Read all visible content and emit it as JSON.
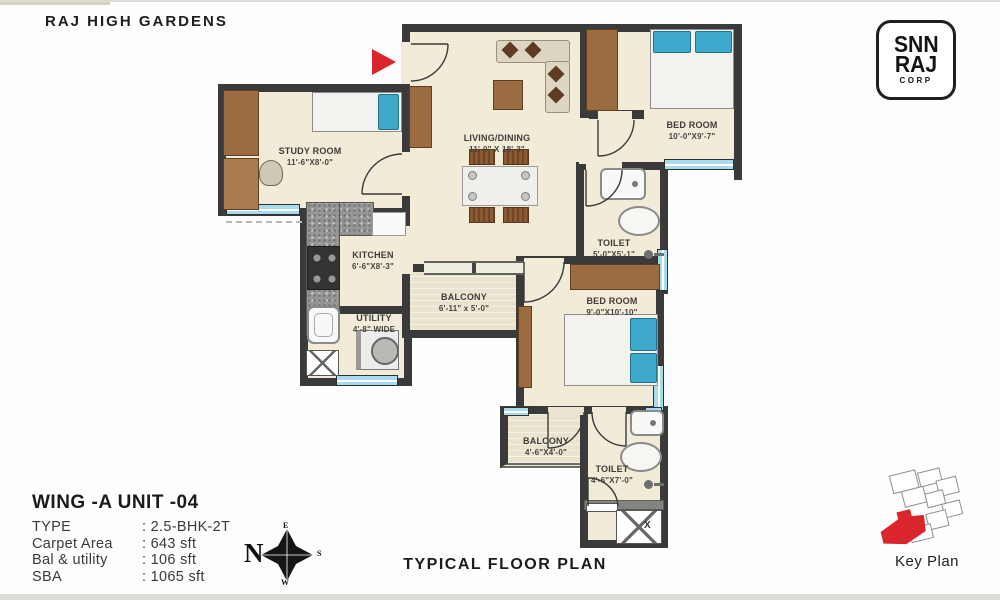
{
  "header": {
    "project_title": "RAJ HIGH GARDENS"
  },
  "logo": {
    "line1": "SNN",
    "line2": "RAJ",
    "line3": "CORP"
  },
  "plan": {
    "rooms": {
      "study": {
        "name": "STUDY ROOM",
        "dims": "11'-6\"X8'-0\""
      },
      "living": {
        "name": "LIVING/DINING",
        "dims": "11'-0\" X 18'-3\""
      },
      "bedroom1": {
        "name": "BED ROOM",
        "dims": "10'-0\"X9'-7\""
      },
      "toilet1": {
        "name": "TOILET",
        "dims": "5'-0\"X5'-1\""
      },
      "kitchen": {
        "name": "KITCHEN",
        "dims": "6'-6\"X8'-3\""
      },
      "utility": {
        "name": "UTILITY",
        "dims": "4'-8\" WIDE"
      },
      "balcony1": {
        "name": "BALCONY",
        "dims": "6'-11\" x 5'-0\""
      },
      "bedroom2": {
        "name": "BED ROOM",
        "dims": "9'-0\"X10'-10\""
      },
      "balcony2": {
        "name": "BALCONY",
        "dims": "4'-6\"X4'-0\""
      },
      "toilet2": {
        "name": "TOILET",
        "dims": "4'-6\"X7'-0\""
      }
    },
    "shaft_label": "X"
  },
  "info": {
    "unit_title": "WING -A  UNIT -04",
    "rows": [
      {
        "label": "TYPE",
        "value": ": 2.5-BHK-2T"
      },
      {
        "label": "Carpet Area",
        "value": ": 643 sft"
      },
      {
        "label": "Bal & utility",
        "value": ": 106 sft"
      },
      {
        "label": "SBA",
        "value": ": 1065 sft"
      }
    ]
  },
  "compass": {
    "n": "N",
    "e": "E",
    "s": "S",
    "w": "W"
  },
  "footer": {
    "plan_type": "TYPICAL FLOOR PLAN"
  },
  "key_plan": {
    "label": "Key Plan"
  },
  "colors": {
    "wall": "#3A3A3A",
    "floor": "#F2EBD8",
    "window": "#A8DCEC",
    "accent_red": "#D9252B",
    "wood": "#9B6B42",
    "pillow": "#3FA9CB"
  }
}
